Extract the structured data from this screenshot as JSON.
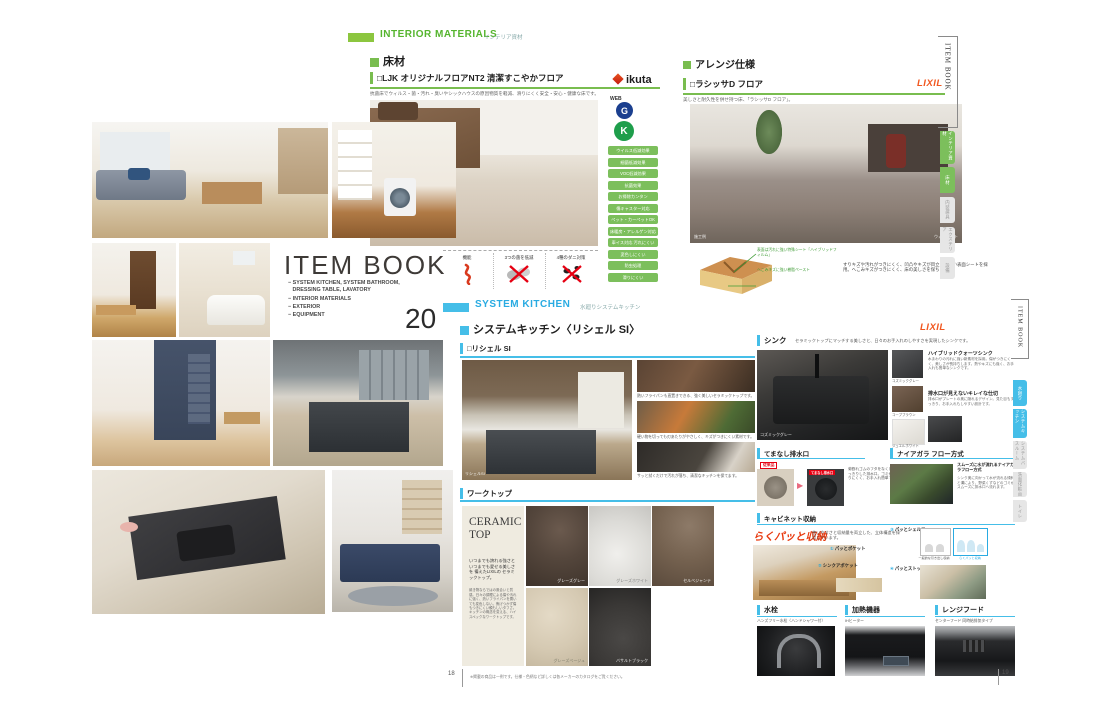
{
  "colors": {
    "green_accent": "#79BD4F",
    "green_header": "#8CC63F",
    "green_text": "#55B52E",
    "cyan_accent": "#45BEE8",
    "cyan_text": "#29ABE2",
    "lixil_orange": "#F1571F",
    "ikuta_red": "#D93A1E",
    "alert_red": "#E60012",
    "catch_red": "#E8380D",
    "tab_gray": "#E6E6E6"
  },
  "item_book": {
    "title": "ITEM BOOK",
    "toc": [
      "− SYSTEM KITCHEN, SYSTEM BATHROOM,",
      "   DRESSING TABLE, LAVATORY",
      "− INTERIOR MATERIALS",
      "− EXTERIOR",
      "− EQUIPMENT"
    ],
    "volume": "20"
  },
  "floor_page": {
    "tag": "INTERIOR MATERIALS",
    "tag_ja": "インテリア資材",
    "edge_title": "ITEM BOOK",
    "edge_tabs": [
      {
        "label": "インテリア資材"
      },
      {
        "label": "床材"
      },
      {
        "label": "内装建具"
      },
      {
        "label": "エクステリア"
      },
      {
        "label": "設備"
      }
    ],
    "floor": {
      "heading": "床材",
      "product": "□LJK オリジナルフロアNT2 清潔すこやかフロア",
      "brand": "ikuta",
      "lead": "抗菌床でウィルス・菌・汚れ・臭いやシックハウスの原因物質を軽減、滑りにくく安全・安心・健康な床です。",
      "web": "WEB",
      "award1": "G",
      "award2": "K",
      "badges": [
        "ウイルス低減効果",
        "細菌低減効果",
        "VOC低減効果",
        "抗菌効果",
        "お掃除カンタン",
        "傷キャスター対応",
        "ペット・カーペットOK",
        "床暖房・アレルゲン対応",
        "車イス対応 汚れにくい",
        "変色しにくい",
        "防虫処理",
        "滑りにくい"
      ],
      "features": [
        {
          "label": "機能"
        },
        {
          "label": "3つの菌を低減"
        },
        {
          "label": "4種のダニ対策"
        }
      ]
    },
    "arrange": {
      "heading": "アレンジ仕様",
      "product": "□ラシッサD フロア",
      "brand": "LIXIL",
      "lead": "美しさと耐久性を併せ持つ床、「ラシッサD フロア」。",
      "photo_caption_left": "施工例",
      "photo_caption_right": "ウォルナット",
      "diagram_note1": "表面は汚れに強い特殊シート「ハイブリッドフィルム」",
      "diagram_note2": "へこみキズに強い樹脂ペースト",
      "diagram_text": "すりキズや汚れがつきにくく、凹凸やキズが目立ちにくい表面シートを採用。へこみキズがつきにくく、床の美しさを保ちます。"
    }
  },
  "kitchen_page": {
    "tag": "SYSTEM KITCHEN",
    "tag_ja": "水廻りシステムキッチン",
    "edge_title": "ITEM BOOK",
    "edge_tabs": [
      {
        "label": "水廻り"
      },
      {
        "label": "システムキッチン"
      },
      {
        "label": "システムバスルーム"
      },
      {
        "label": "洗面化粧台"
      },
      {
        "label": "トイレ"
      }
    ],
    "heading": "システムキッチン〈リシェル SI〉",
    "brand": "LIXIL",
    "model": "□リシェル SI",
    "photo_caption": "リシェルSI",
    "photo_notes": [
      "熱いフライパンも直置きできる、強く美しいセラミックトップです。",
      "硬い物を切っても刃あたりがやさしく、キズがつきにくい素材です。",
      "サッと拭くだけで汚れが落ち、清潔なキッチンを保てます。"
    ],
    "worktop": {
      "heading": "ワークトップ",
      "panel_title": "CERAMIC TOP",
      "panel_lead": "いつまでも誇れる強さと いつまでも愛せる美しさを 備えたLIXILの セラミックトップ。",
      "panel_body": "焼き物ならではの風合いと質感。日々の調理による傷や汚れに強く、熱いフライパンを置いても変色しない。焦げつかず傷もつきにくい頼もしいタフさ。キッチンの概念を変える、ハイスペックなワークトップです。",
      "swatches": [
        "グレーズグレー",
        "グレーズホワイト",
        "セルベジャンテ",
        "グレーズベージュ",
        "バサルトブラック"
      ]
    },
    "sink": {
      "heading": "シンク",
      "lead": "セラミックトップにマッチする美しさと、日々のお手入れのしやすさを実現したシンクです。",
      "photo_caption": "コズミックグレー",
      "swatches": [
        "コズミックグレー",
        "コーブブラウン",
        "ジュエルホワイト"
      ],
      "feature1_title": "ハイブリッドクォーツシンク",
      "feature1_text": "水まわりの汚れに強い新素材を採用。傷がつきにくく、美しさが長持ちします。熱やキズにも強く、お手入れも簡単なシンクです。",
      "feature2_title": "排水口が見えないキレイな仕切",
      "feature2_text": "排水口がプレートの奥に隠れるデザイン。見た目もすっきり、お手入れもしやすい設計です。"
    },
    "drain": {
      "heading": "てまなし排水口",
      "label_before": "従来品",
      "label_after": "てまなし排水口",
      "text": "菊割れゴムのフタをなくし、すっきりした排水口。ゴミがたまりにくく、お手入れ簡単です。"
    },
    "niagara": {
      "heading": "ナイアガラ フロー方式",
      "title": "スムーズに水が流れるナイアガラフロー方式",
      "text": "シンク奥に向かって水が流れる傾斜と溝により、野菜くずなどのゴミがスムーズに排水口へ流れます。"
    },
    "cabinet": {
      "heading": "キャビネット収納",
      "catch": "らくパッと収納",
      "lead": "使いやすさと収納量を両立した、立体構造を採用しています。",
      "items": [
        {
          "no": "①",
          "label": "パッとポケット"
        },
        {
          "no": "②",
          "label": "シンクアポケット"
        },
        {
          "no": "③",
          "label": "パッとシェルフ"
        },
        {
          "no": "④",
          "label": "パッとストッカー"
        }
      ],
      "diagram_label1": "一般的な引き出し収納",
      "diagram_label2": "らくパッと収納"
    },
    "faucet": {
      "heading": "水栓",
      "caption": "ハンズフリー水栓〈ハンドシャワー付〉"
    },
    "heater": {
      "heading": "加熱機器",
      "caption": "IHヒーター"
    },
    "hood": {
      "heading": "レンジフード",
      "caption": "センターフード 同時給排気タイプ"
    },
    "footnote": "※掲載の商品は一例です。仕様・色柄など詳しくは各メーカーのカタログをご覧ください。",
    "page_left": "18",
    "page_right": "19"
  }
}
